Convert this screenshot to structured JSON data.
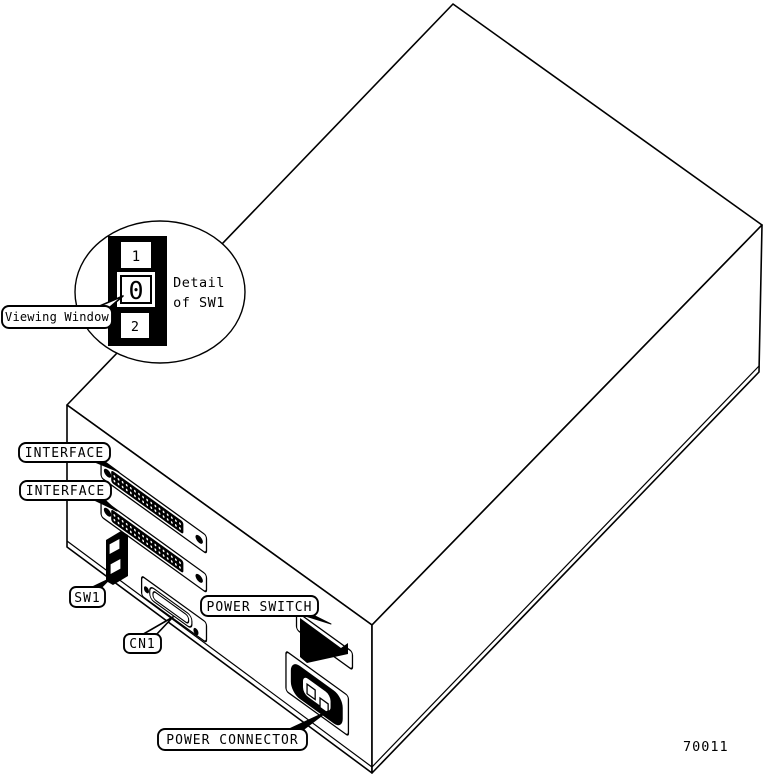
{
  "figure": {
    "background": "#ffffff",
    "line_color": "#000000",
    "figure_number": "70011",
    "detail_balloon": {
      "caption_line1": "Detail",
      "caption_line2": "of SW1",
      "switch_positions": {
        "top": "1",
        "window": "0",
        "bottom": "2"
      }
    },
    "callouts": {
      "viewing_window": "Viewing Window",
      "interface_top": "INTERFACE",
      "interface_bottom": "INTERFACE",
      "sw1": "SW1",
      "cn1": "CN1",
      "power_switch": "POWER SWITCH",
      "power_connector": "POWER CONNECTOR"
    }
  }
}
